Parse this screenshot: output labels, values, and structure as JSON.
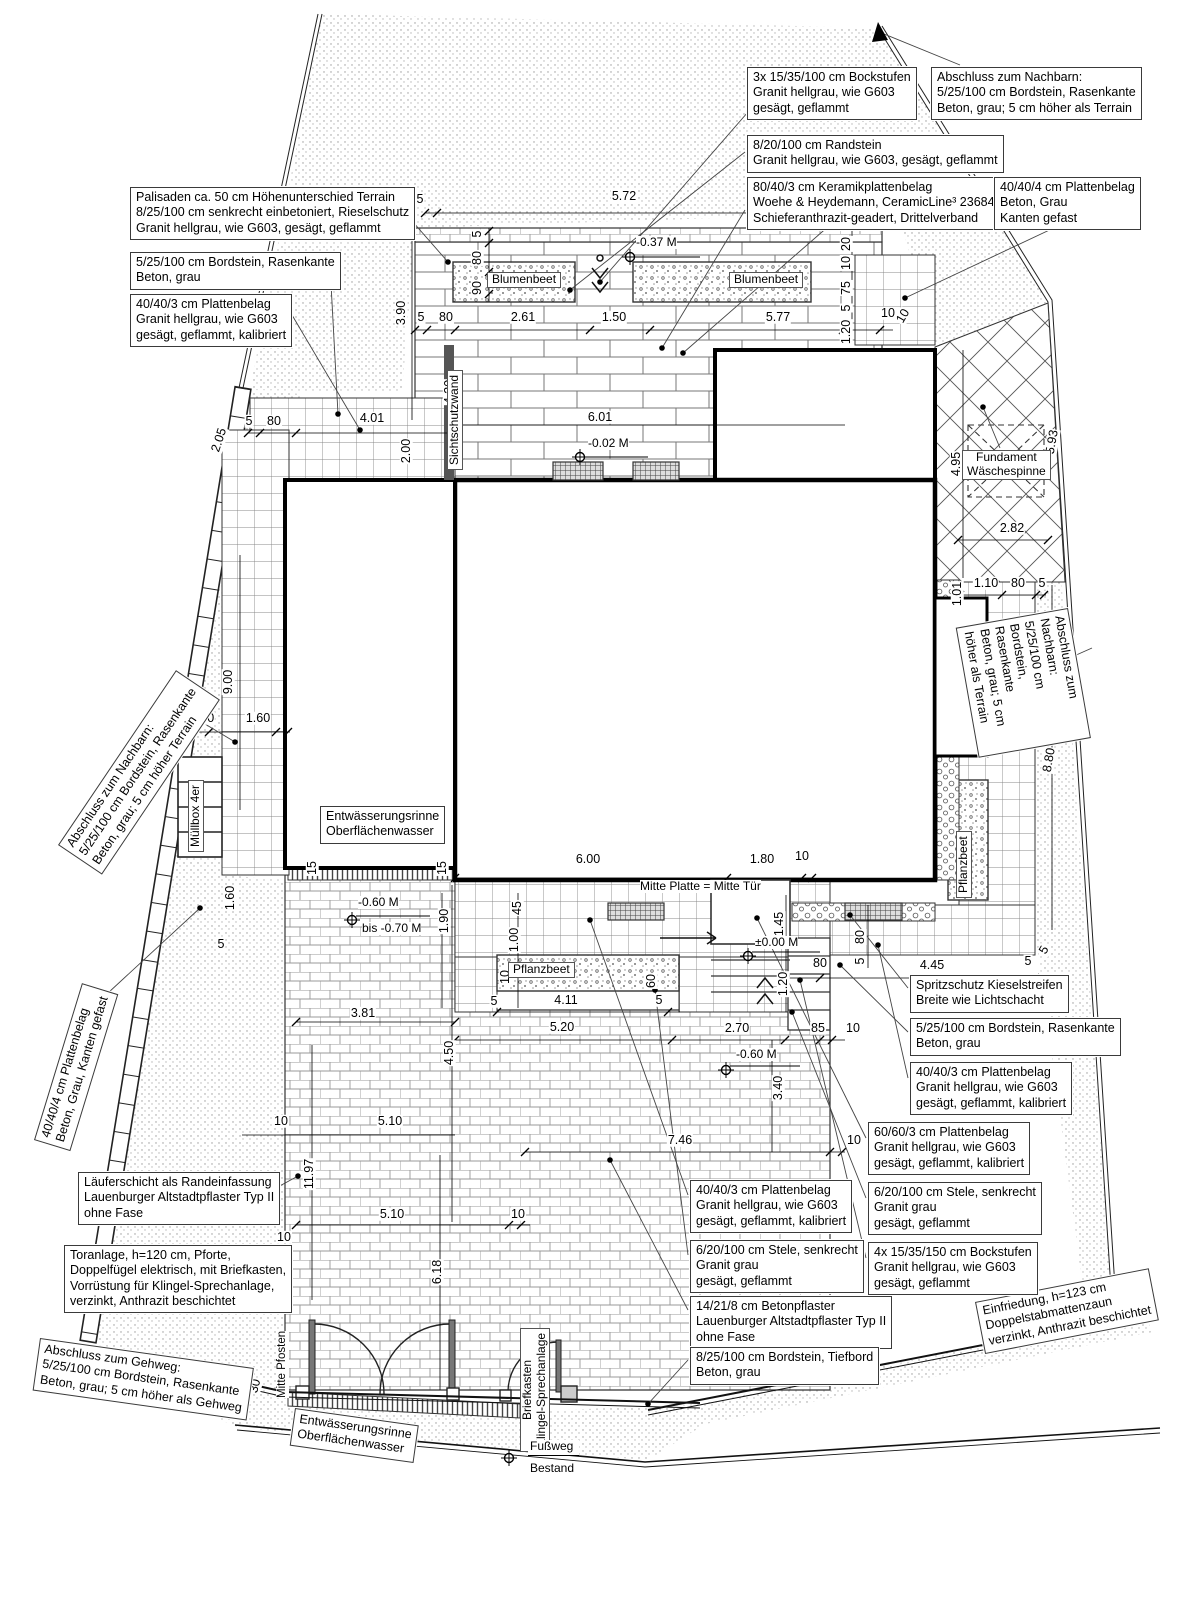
{
  "boxes": {
    "palisaden": "Palisaden ca. 50 cm Höhenunterschied Terrain\n8/25/100 cm senkrecht einbetoniert, Rieselschutz\nGranit hellgrau, wie G603, gesägt, geflammt",
    "bordstein_left": "5/25/100 cm Bordstein, Rasenkante\nBeton, grau",
    "platten_403_left": "40/40/3 cm Plattenbelag\nGranit hellgrau, wie G603\ngesägt, geflammt, kalibriert",
    "bockstufen3": "3x 15/35/100 cm Bockstufen\nGranit hellgrau, wie G603\ngesägt, geflammt",
    "abschluss_nachbar_top": "Abschluss zum Nachbarn:\n5/25/100 cm Bordstein, Rasenkante\nBeton, grau; 5 cm höher als Terrain",
    "randstein": "8/20/100 cm Randstein\nGranit hellgrau, wie G603, gesägt, geflammt",
    "keramik": "80/40/3 cm Keramikplattenbelag\nWoehe & Heydemann, CeramicLine³ 23684\nSchieferanthrazit-geadert, Drittelverband",
    "platten_404_top": "40/40/4 cm Plattenbelag\nBeton, Grau\nKanten gefast",
    "abschluss_nachbar_left": "Abschluss zum Nachbarn:\n5/25/100 cm Bordstein, Rasenkante\nBeton, grau; 5 cm höher Terrain",
    "platten_404_left": "40/40/4 cm Plattenbelag\nBeton, Grau, Kanten gefast",
    "abschluss_nachbar_right": "Abschluss zum Nachbarn:\n5/25/100 cm Bordstein, Rasenkante\nBeton, grau; 5 cm höher als Terrain",
    "laeuferschicht": "Läuferschicht als Randeinfassung\nLauenburger Altstadtpflaster Typ II\nohne Fase",
    "toranlage": "Toranlage, h=120 cm, Pforte,\nDoppelfügel elektrisch, mit Briefkasten,\nVorrüstung für Klingel-Sprechanlage,\nverzinkt, Anthrazit beschichtet",
    "abschluss_gehweg": "Abschluss zum Gehweg:\n5/25/100 cm Bordstein, Rasenkante\nBeton, grau; 5 cm höher als Gehweg",
    "rinne_garage": "Entwässerungsrinne\nOberflächenwasser",
    "rinne_gate": "Entwässerungsrinne\nOberflächenwasser",
    "spritzschutz": "Spritzschutz Kieselstreifen\nBreite wie Lichtschacht",
    "bordstein_right": "5/25/100 cm Bordstein, Rasenkante\nBeton, grau",
    "platten_403_right": "40/40/3 cm Plattenbelag\nGranit hellgrau, wie G603\ngesägt, geflammt, kalibriert",
    "platten_603": "60/60/3 cm Plattenbelag\nGranit hellgrau, wie G603\ngesägt, geflammt, kalibriert",
    "stele_right": "6/20/100 cm Stele, senkrecht\nGranit grau\ngesägt, geflammt",
    "bockstufen4": "4x 15/35/150 cm Bockstufen\nGranit hellgrau, wie G603\ngesägt, geflammt",
    "platten_403_mid": "40/40/3 cm Plattenbelag\nGranit hellgrau, wie G603\ngesägt, geflammt, kalibriert",
    "stele_mid": "6/20/100 cm Stele, senkrecht\nGranit grau\ngesägt, geflammt",
    "betonpflaster": "14/21/8 cm Betonpflaster\nLauenburger Altstadtpflaster Typ II\nohne Fase",
    "tiefbord": "8/25/100 cm Bordstein, Tiefbord\nBeton, grau",
    "einfriedung": "Einfriedung, h=123 cm\nDoppelstabmattenzaun\nverzinkt, Anthrazit beschichtet",
    "fundament": "Fundament\nWäschespinne"
  },
  "labels": {
    "blumenbeet1": "Blumenbeet",
    "blumenbeet2": "Blumenbeet",
    "pflanzbeet1": "Pflanzbeet",
    "pflanzbeet2": "Pflanzbeet",
    "muellbox": "Müllbox 4er",
    "sichtschutz": "Sichtschutzwand",
    "briefkasten": "Briefkasten\nKlingel-Sprechanlage",
    "mitte_pfosten": "Mitte Pfosten",
    "mitte_platte": "Mitte Platte = Mitte Tür",
    "fussweg": "Fußweg",
    "bestand": "Bestand"
  },
  "elev": {
    "m037": "-0.37 M",
    "m002": "-0.02 M",
    "m060": "-0.60 M",
    "m070": "bis -0.70 M",
    "m000": "±0.00 M",
    "m060b": "-0.60 M"
  },
  "dims": {
    "top": [
      "5",
      "5.72",
      "5"
    ],
    "beet": [
      "5",
      "80",
      "90"
    ],
    "upper": [
      "5",
      "80",
      "2.61",
      "1.50",
      "5.77",
      "10"
    ],
    "leftcol": [
      "3.90",
      "4.20",
      "2.00",
      "2.05",
      "9.00",
      "1.60",
      "5"
    ],
    "path": [
      "5",
      "80",
      "4.01"
    ],
    "mull": [
      "5",
      "1.00",
      "1.60"
    ],
    "gar": [
      "15",
      "15"
    ],
    "house": [
      "6.00",
      "1.80",
      "10"
    ],
    "hausdim": [
      "6.01"
    ],
    "entr": [
      "1.45",
      "1.20"
    ],
    "terr": [
      "1.90",
      "45",
      "1.00",
      "10",
      "60",
      "5",
      "4.11",
      "5"
    ],
    "drive": [
      "5.20",
      "2.70",
      "85",
      "10",
      "3.81",
      "4.50",
      "5.10",
      "10",
      "11.97",
      "10",
      "5.10",
      "10",
      "6.18",
      "7.46",
      "10",
      "3.40",
      "30"
    ],
    "kies": [
      "80",
      "5",
      "80",
      "4.45",
      "5",
      "5"
    ],
    "lawn": [
      "4.95",
      "5.93",
      "2.82",
      "1.01",
      "1.10",
      "80",
      "5",
      "8.80"
    ],
    "rstack": [
      "20",
      "10",
      "75",
      "5",
      "1.20",
      "10"
    ]
  }
}
